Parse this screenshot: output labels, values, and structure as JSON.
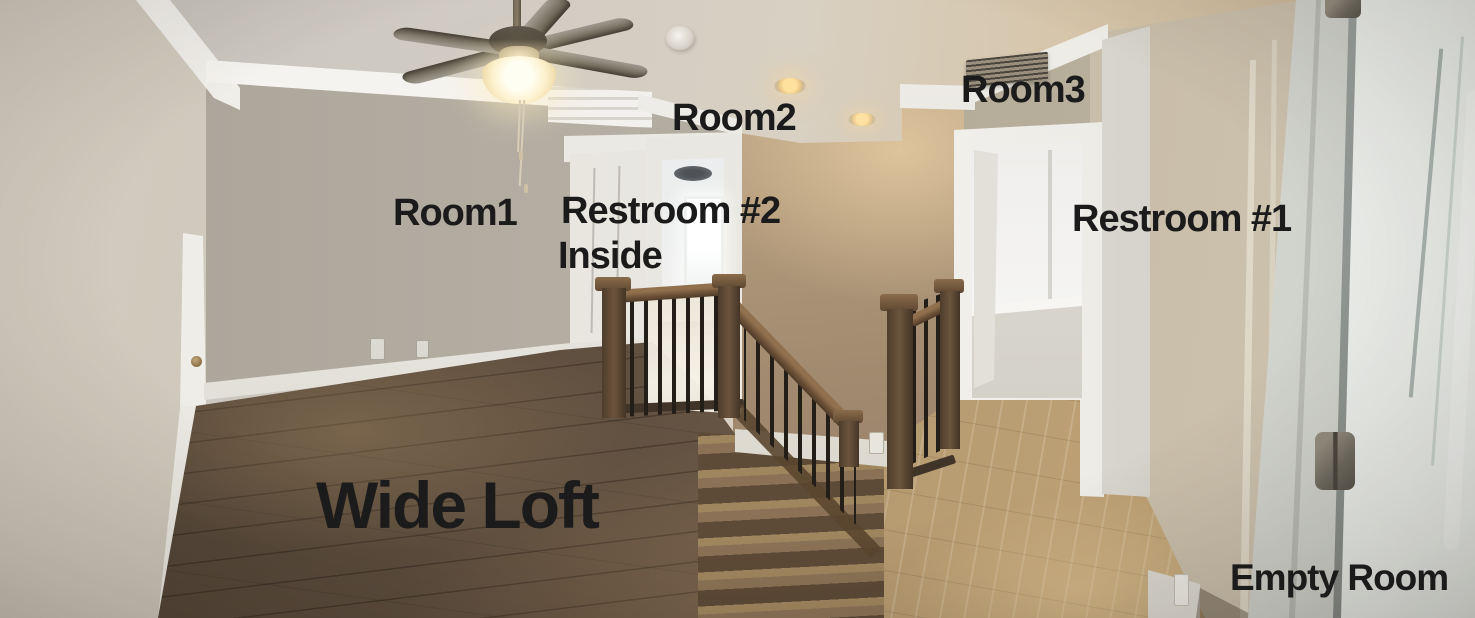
{
  "annotations": {
    "room1": "Room1",
    "room2": "Room2",
    "room3": "Room3",
    "restroom2_line1": "Restroom #2",
    "restroom2_line2": "Inside",
    "restroom1": "Restroom #1",
    "wide_loft": "Wide Loft",
    "empty_room": "Empty Room"
  },
  "colors": {
    "label_text": "#1b1b1b",
    "ceiling": "#d3cbbd",
    "wall_left": "#c8c1b4",
    "wall_back": "#b5aea3",
    "wall_tan": "#a98f72",
    "wall_right": "#c2b8a7",
    "trim_white": "#eceae4",
    "floor_dark": "#5a4b3c",
    "floor_stairs": "#8b7256",
    "floor_hall": "#b0976f",
    "handrail": "#6a4f36",
    "baluster": "#241e18",
    "entry_door": "#e2e7e4",
    "light_glow": "#ffe19e"
  }
}
